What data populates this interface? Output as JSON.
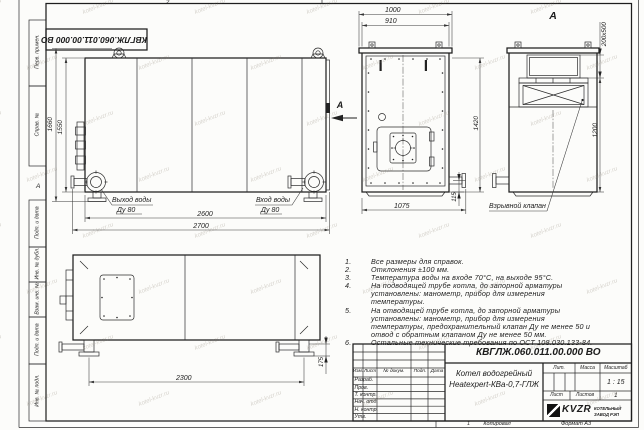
{
  "watermark": {
    "text": "kotel-kvzr.ru"
  },
  "sheet": {
    "stamp_top": "КВГЛЖ.060.011.00.000 ВО",
    "zone_top": "2",
    "zone_bottom": "1",
    "zone_left": "А",
    "copied_label": "Копировал",
    "format_label": "Формат А3",
    "margin_labels": [
      "Перв. примен.",
      "Справ. №",
      "Подп. и дата",
      "Инв. № дубл.",
      "Взам. инв. №",
      "Подп. и дата",
      "Инв. № подл."
    ]
  },
  "front_view": {
    "dim_width_body": "2600",
    "dim_width_total": "2700",
    "dim_height_total": "1660",
    "dim_height_body": "1550",
    "outlet_label": "Выход воды",
    "outlet_dn": "Ду 80",
    "inlet_label": "Вход воды",
    "inlet_dn": "Ду 80",
    "view_arrow": "А"
  },
  "side_view": {
    "dim_top_outer": "1000",
    "dim_top_inner": "910",
    "dim_height": "1420",
    "dim_bottom": "1075",
    "dim_stub": "115"
  },
  "view_a": {
    "title": "А",
    "dim_flue": "200х500",
    "dim_height": "1200",
    "valve_label": "Взрывной клапан"
  },
  "top_view": {
    "dim_length": "2300",
    "dim_foot": "175"
  },
  "notes": {
    "items": [
      {
        "num": "1.",
        "text": "Все размеры для справок."
      },
      {
        "num": "2.",
        "text": "Отклонения ±100 мм."
      },
      {
        "num": "3.",
        "text": "Температура воды на входе 70°С, на выходе 95°С."
      },
      {
        "num": "4.",
        "text": "На подводящей трубе котла, до запорной арматуры установлены: манометр, прибор для измерения температуры."
      },
      {
        "num": "5.",
        "text": "На отводящей трубе котла, до запорной арматуры установлены: манометр, прибор для измерения температуры, предохранительный клапан Ду не менее 50 и отвод с обратным клапаном Ду не менее 50 мм."
      },
      {
        "num": "6.",
        "text": "Остальные технические требования по ОСТ 108.030.133-84."
      }
    ]
  },
  "title_block": {
    "doc_number": "КВГЛЖ.060.011.00.000 ВО",
    "name_line1": "Котел водогрейный",
    "name_line2": "Heatexpert-КВа-0,7-ГЛЖ",
    "col_izm": "Изм.",
    "col_list": "Лист",
    "col_doc": "№ докум.",
    "col_podp": "Подп.",
    "col_data": "Дата",
    "rows": [
      "Разраб.",
      "Пров.",
      "Т. контр.",
      "Нач. отд.",
      "Н. контр.",
      "Утв."
    ],
    "lit_label": "Лит.",
    "mass_label": "Масса",
    "scale_label": "Масштаб",
    "scale_value": "1 : 15",
    "sheet_label": "Лист",
    "sheets_label": "Листов",
    "sheets_value": "1",
    "company_logo": "KVZR",
    "company_line1": "КОТЕЛЬНЫЙ",
    "company_line2": "ЗАВОД РЭП"
  }
}
